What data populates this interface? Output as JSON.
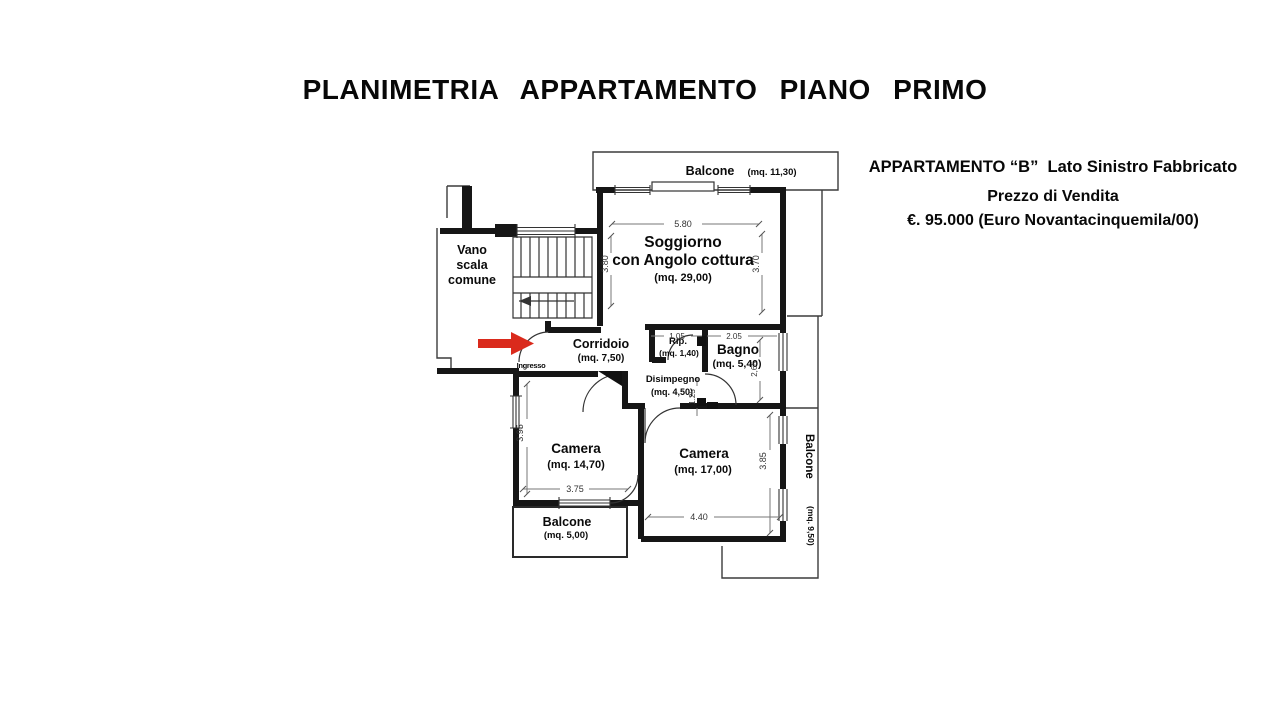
{
  "page": {
    "title": "PLANIMETRIA APPARTAMENTO PIANO PRIMO"
  },
  "listing": {
    "line1": "APPARTAMENTO “B”  Lato Sinistro Fabbricato",
    "line2": "Prezzo di Vendita",
    "line3": "€. 95.000 (Euro Novantacinquemila/00)"
  },
  "plan": {
    "rooms": {
      "balcone_top": {
        "name": "Balcone",
        "area": "(mq. 11,30)"
      },
      "soggiorno": {
        "name_line1": "Soggiorno",
        "name_line2": "con Angolo cottura",
        "area": "(mq. 29,00)"
      },
      "vano_scala": {
        "line1": "Vano",
        "line2": "scala",
        "line3": "comune"
      },
      "corridoio": {
        "name": "Corridoio",
        "area": "(mq. 7,50)"
      },
      "rip": {
        "name": "Rip.",
        "area": "(mq. 1,40)"
      },
      "bagno": {
        "name": "Bagno",
        "area": "(mq. 5,40)"
      },
      "disimpegno": {
        "name": "Disimpegno",
        "area": "(mq. 4,50)"
      },
      "camera_sx": {
        "name": "Camera",
        "area": "(mq. 14,70)"
      },
      "camera_dx": {
        "name": "Camera",
        "area": "(mq. 17,00)"
      },
      "balcone_sx": {
        "name": "Balcone",
        "area": "(mq. 5,00)"
      },
      "balcone_dx": {
        "name": "Balcone",
        "area": "(mq. 9,50)"
      },
      "ingresso": "Ingresso"
    },
    "dimensions": {
      "soggiorno_larghezza": "5.80",
      "soggiorno_altezza_sx": "3.80",
      "soggiorno_altezza_dx": "3.70",
      "rip_larghezza": "1.05",
      "bagno_larghezza": "2.05",
      "bagno_altezza": "2,65",
      "disimpegno_altezza": "1.25",
      "camera_sx_altezza": "3.95",
      "camera_sx_larghezza": "3.75",
      "camera_dx_larghezza": "4.40",
      "camera_dx_altezza": "3.85"
    },
    "colors": {
      "arrow_red": "#da2a1c",
      "wall": "#1a1a1a"
    }
  }
}
